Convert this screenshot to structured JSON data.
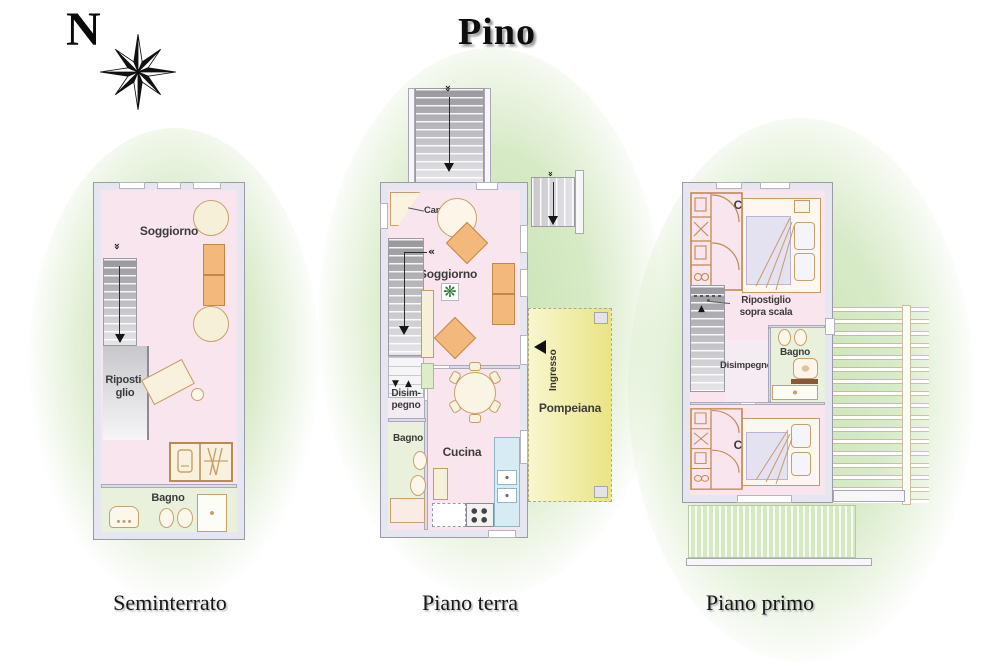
{
  "title": "Pino",
  "compass": {
    "north": "N"
  },
  "icons": {
    "chevron_double": "«",
    "arrow_up": "▲",
    "arrow_down": "▼",
    "plant": "❋"
  },
  "captions": {
    "seminterrato": "Seminterrato",
    "piano_terra": "Piano terra",
    "piano_primo": "Piano primo"
  },
  "seminterrato": {
    "soggiorno": "Soggiorno",
    "ripostiglio": "Riposti-\nglio",
    "bagno": "Bagno"
  },
  "piano_terra": {
    "caminetto": "Caminetto",
    "soggiorno": "Soggiorno",
    "disimpegno": "Disim-\npegno",
    "bagno": "Bagno",
    "cucina": "Cucina",
    "ingresso": "Ingresso",
    "pompeiana": "Pompeiana"
  },
  "piano_primo": {
    "camera_top": "Camera",
    "ripostiglio_sopra_scala": "Ripostiglio\nsopra scala",
    "disimpegno": "Disimpegno",
    "bagno": "Bagno",
    "camera_bottom": "Camera"
  },
  "colors": {
    "floor_pink": "#f9e5ed",
    "bath_green": "#e9f1dc",
    "wall": "#e6e6f0",
    "furniture_orange": "#f3b97b",
    "furniture_tan": "#c59a63",
    "pompeiana_yellow": "#efe996",
    "garden_green": "#cfe5bb",
    "kitchen_blue": "#d6ebf3"
  }
}
